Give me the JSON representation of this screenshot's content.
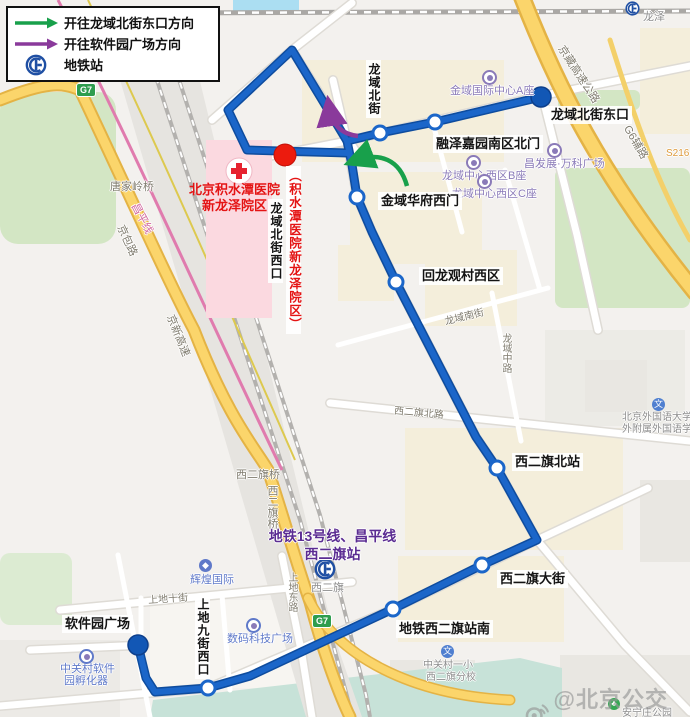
{
  "legend": {
    "items": [
      {
        "label": "开往龙域北街东口方向",
        "arrow_color": "#18a04b"
      },
      {
        "label": "开往软件园广场方向",
        "arrow_color": "#8a3a9b"
      },
      {
        "label": "地铁站",
        "icon_color": "#1f4fa3"
      }
    ]
  },
  "route": {
    "color": "#1b66c9",
    "terminus_color": "#1257b5",
    "highlight_stop_color": "#ec1b0e"
  },
  "stops": [
    {
      "name": "龙域北街东口",
      "type": "terminus"
    },
    {
      "name": "融泽嘉园南区北门",
      "type": "stop"
    },
    {
      "name": "龙域北街",
      "type": "stop"
    },
    {
      "name": "龙域北街西口",
      "alt": "（积水潭医院新龙泽院区）",
      "type": "highlight"
    },
    {
      "name": "金域华府西门",
      "type": "stop"
    },
    {
      "name": "回龙观村西区",
      "type": "stop"
    },
    {
      "name": "西二旗北站",
      "type": "stop"
    },
    {
      "name": "西二旗大街",
      "type": "stop"
    },
    {
      "name": "地铁西二旗站南",
      "type": "stop"
    },
    {
      "name": "上地九街西口",
      "type": "stop"
    },
    {
      "name": "软件园广场",
      "type": "terminus"
    }
  ],
  "hospital": {
    "line1": "北京积水潭医院",
    "line2": "新龙泽院区"
  },
  "metro_note": {
    "line1": "地铁13号线、昌平线",
    "line2": "西二旗站"
  },
  "bg": {
    "longze": "龙泽",
    "jinyu_center": "金域国际中心A座",
    "changfazhan": "昌发展·万科广场",
    "longyu_b": "龙域中心西区B座",
    "longyu_c": "龙域中心西区C座",
    "jingzang": "京藏高速公路",
    "g6_service": "G6辅路",
    "s216": "S216",
    "tangjialing": "唐家岭桥",
    "jingbao": "京包路",
    "jingxin": "京新高速",
    "changping_line": "昌平线",
    "xierqi_bridge": "西二旗桥",
    "xierqi_north_rd": "西二旗北路",
    "longyu_south_st": "龙域南街",
    "longyu_mid_rd": "龙域中路",
    "shangdi_10": "上地十街",
    "shangdi_east": "上地东路",
    "xierqi": "西二旗",
    "huihuang": "辉煌国际",
    "shuma": "数码科技广场",
    "incubator1": "中关村软件",
    "incubator2": "园孵化器",
    "zgc_school1": "中关村一小",
    "zgc_school2": "西二旗分校",
    "bfs1": "北京外国语大学北",
    "bfs2": "外附属外国语学校",
    "anningzhuang": "安宁庄公园",
    "g7": "G7",
    "school_glyph": "文"
  },
  "watermark": {
    "text": "@北京公交集团"
  }
}
